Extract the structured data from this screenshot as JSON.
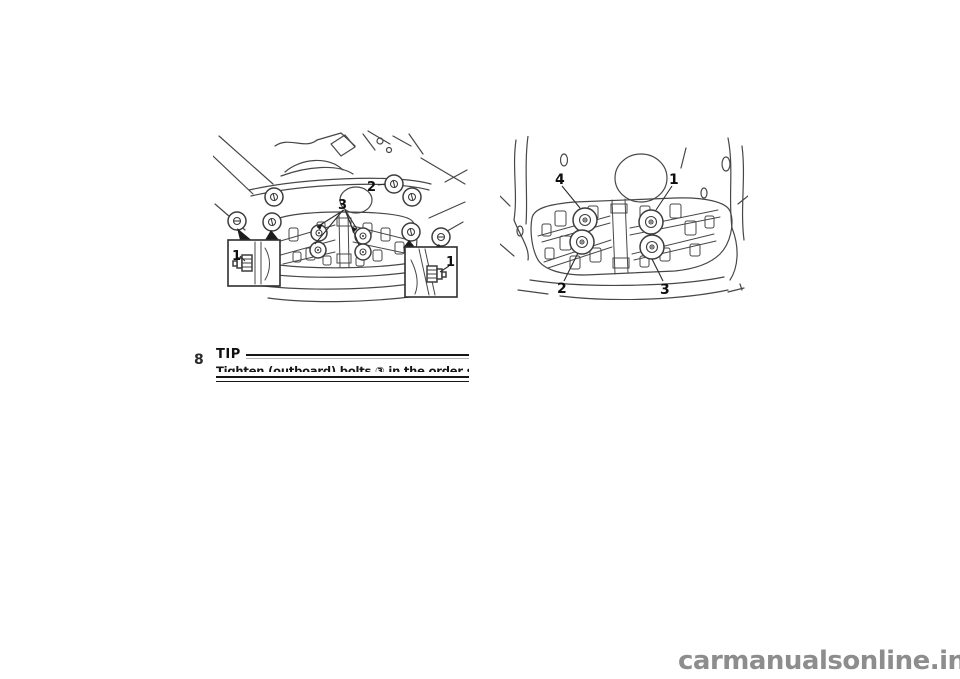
{
  "page": {
    "background_color": "#ffffff",
    "kind": "owner-manual-scanned-page"
  },
  "chapter_number": "8",
  "figure_1": {
    "name": "engine-skid-plate-bolt-locations",
    "label_1_left": "1",
    "label_1_right": "1",
    "label_2": "2",
    "label_3": "3"
  },
  "figure_2": {
    "name": "skid-plate-bolt-tightening-order",
    "label_1": "1",
    "label_2": "2",
    "label_3": "3",
    "label_4": "4"
  },
  "tip": {
    "heading": "TIP",
    "body": "Tighten (outboard) bolts ③ in the order shown."
  },
  "watermark": {
    "text": "carmanualsonline.info",
    "color": "#8d8d8d"
  },
  "art_colors": {
    "line": "#474747",
    "label": "#0f0f0f"
  }
}
